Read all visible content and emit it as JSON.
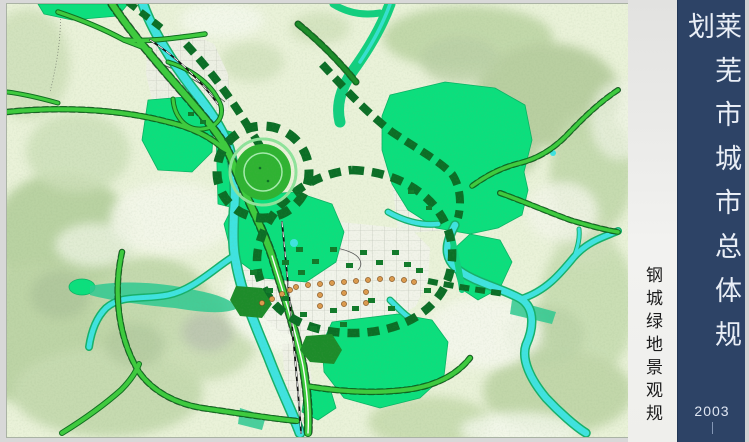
{
  "page": {
    "background": "#d8d8d8"
  },
  "panel": {
    "title": "莱芜市城市总体规划",
    "year": "2003",
    "bg_color": "#2d4366",
    "text_color": "#e9eef6"
  },
  "strip": {
    "label": "钢城绿地景观规",
    "bg_color": "#f2f2f0",
    "text_color": "#1c1c1c"
  },
  "map": {
    "type": "urban-master-plan-map",
    "colors": {
      "background": "#eaf2d9",
      "greenspace": "#0bdf7d",
      "park_dark": "#0b6e26",
      "road_green": "#3ecb3e",
      "water": "#3fe3e0",
      "hills": "#c3d8ab",
      "urban": "#f1f3ea",
      "node_dot": "#dc9a4e"
    },
    "features": [
      "greenbelt-ring-boulevard",
      "central-circular-landmark-park",
      "north-south-river-corridor",
      "east-river-corridor",
      "diagonal-highway",
      "city-core-street-grid",
      "orange-node-string"
    ]
  }
}
